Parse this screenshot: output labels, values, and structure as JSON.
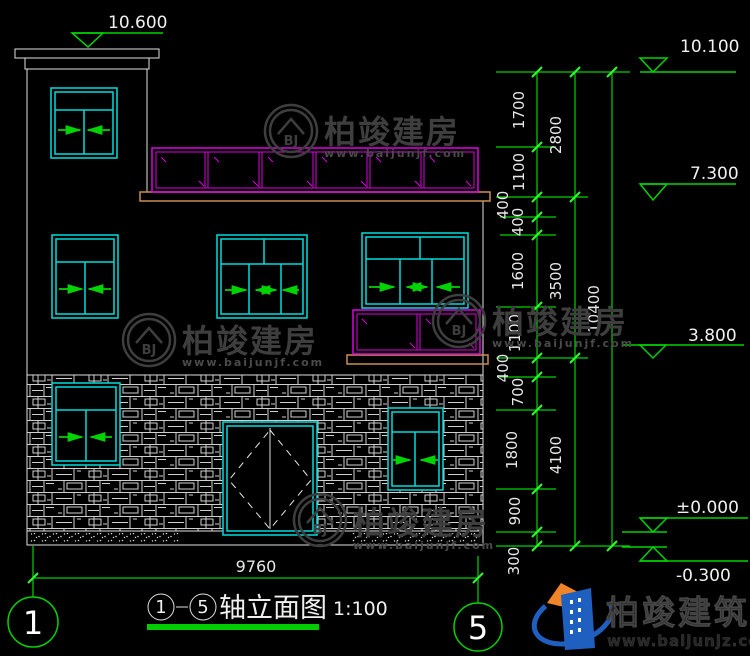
{
  "drawing": {
    "title": {
      "axis_start": "1",
      "axis_end": "5",
      "name": "轴立面图",
      "scale": "1:100"
    },
    "axes": {
      "left": "1",
      "right": "5"
    },
    "elevation_marks": {
      "tower_top": "10.600",
      "roof": "10.100",
      "level3": "7.300",
      "level2": "3.800",
      "ground": "±0.000",
      "below_ground": "-0.300"
    },
    "dimensions": {
      "width_total": "9760",
      "height_total": "10400",
      "floor_heights": [
        "2800",
        "3500",
        "4100"
      ],
      "segments": [
        "1700",
        "1100",
        "400",
        "400",
        "1600",
        "1100",
        "400",
        "700",
        "1800",
        "900",
        "300"
      ]
    }
  },
  "watermark": {
    "brand": "柏竣建房",
    "url": "www.baijunjf.com",
    "monogram": "BJ"
  },
  "logo": {
    "brand": "柏竣建筑",
    "url": "www.baijunjz.com"
  }
}
